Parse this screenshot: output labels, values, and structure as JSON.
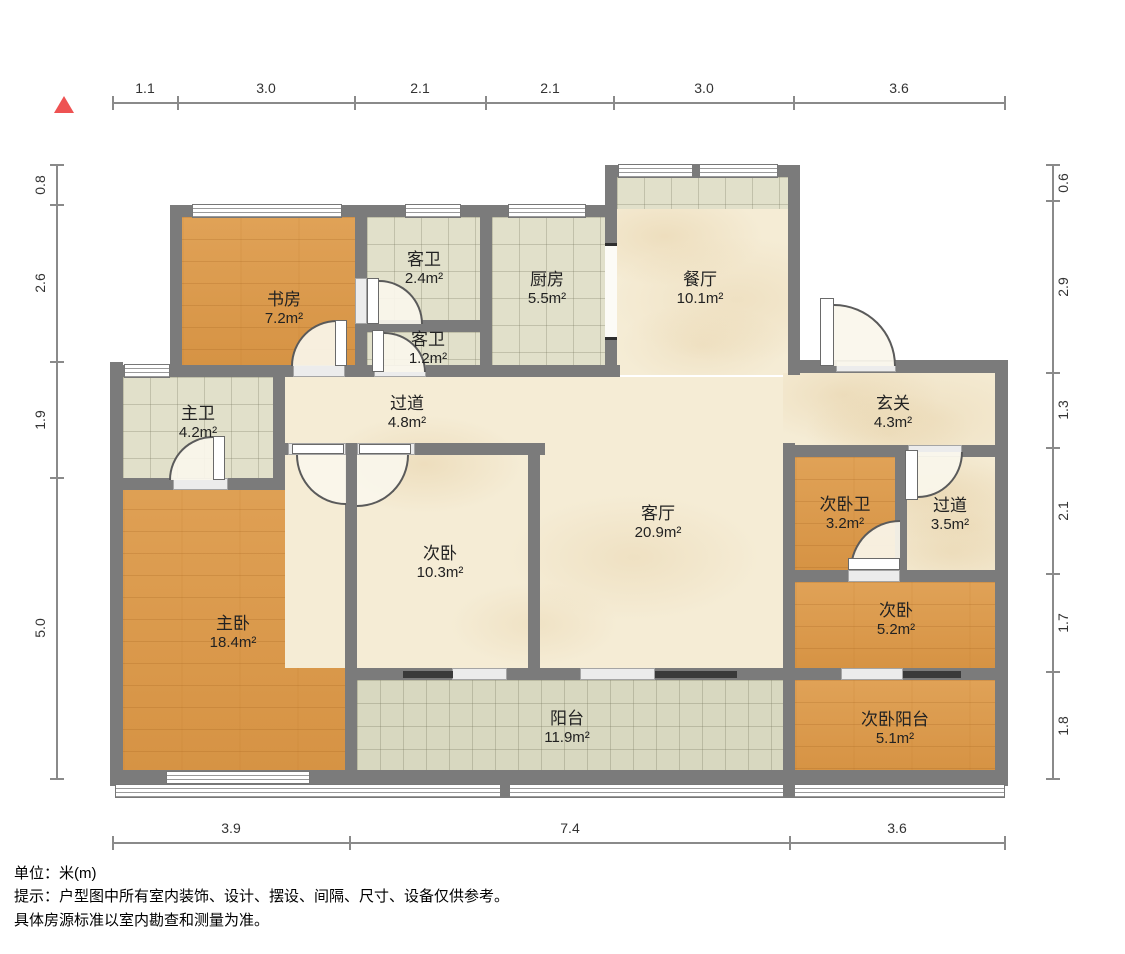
{
  "north_indicator": "north-arrow",
  "colors": {
    "wall": "#7b7b7b",
    "wood_floor": "#dc9c4e",
    "tile_floor": "#e1e0ca",
    "marble_floor": "#f5ecd5",
    "balcony_tile": "#d8d8c0",
    "north_arrow": "#ee5252"
  },
  "rooms": [
    {
      "name": "书房",
      "area": "7.2m²"
    },
    {
      "name": "客卫",
      "area": "2.4m²"
    },
    {
      "name": "厨房",
      "area": "5.5m²"
    },
    {
      "name": "餐厅",
      "area": "10.1m²"
    },
    {
      "name": "客卫",
      "area": "1.2m²"
    },
    {
      "name": "过道",
      "area": "4.8m²"
    },
    {
      "name": "玄关",
      "area": "4.3m²"
    },
    {
      "name": "主卫",
      "area": "4.2m²"
    },
    {
      "name": "次卧",
      "area": "10.3m²"
    },
    {
      "name": "客厅",
      "area": "20.9m²"
    },
    {
      "name": "次卧卫",
      "area": "3.2m²"
    },
    {
      "name": "过道",
      "area": "3.5m²"
    },
    {
      "name": "主卧",
      "area": "18.4m²"
    },
    {
      "name": "次卧",
      "area": "5.2m²"
    },
    {
      "name": "阳台",
      "area": "11.9m²"
    },
    {
      "name": "次卧阳台",
      "area": "5.1m²"
    }
  ],
  "dimensions": {
    "top": [
      "1.1",
      "3.0",
      "2.1",
      "2.1",
      "3.0",
      "3.6"
    ],
    "left": [
      "0.8",
      "2.6",
      "1.9",
      "5.0"
    ],
    "right": [
      "0.6",
      "2.9",
      "1.3",
      "2.1",
      "1.7",
      "1.8"
    ],
    "bottom": [
      "3.9",
      "7.4",
      "3.6"
    ]
  },
  "notes": {
    "unit": "单位：米(m)",
    "tip": "提示：户型图中所有室内装饰、设计、摆设、间隔、尺寸、设备仅供参考。",
    "tip2": "具体房源标准以室内勘查和测量为准。"
  }
}
